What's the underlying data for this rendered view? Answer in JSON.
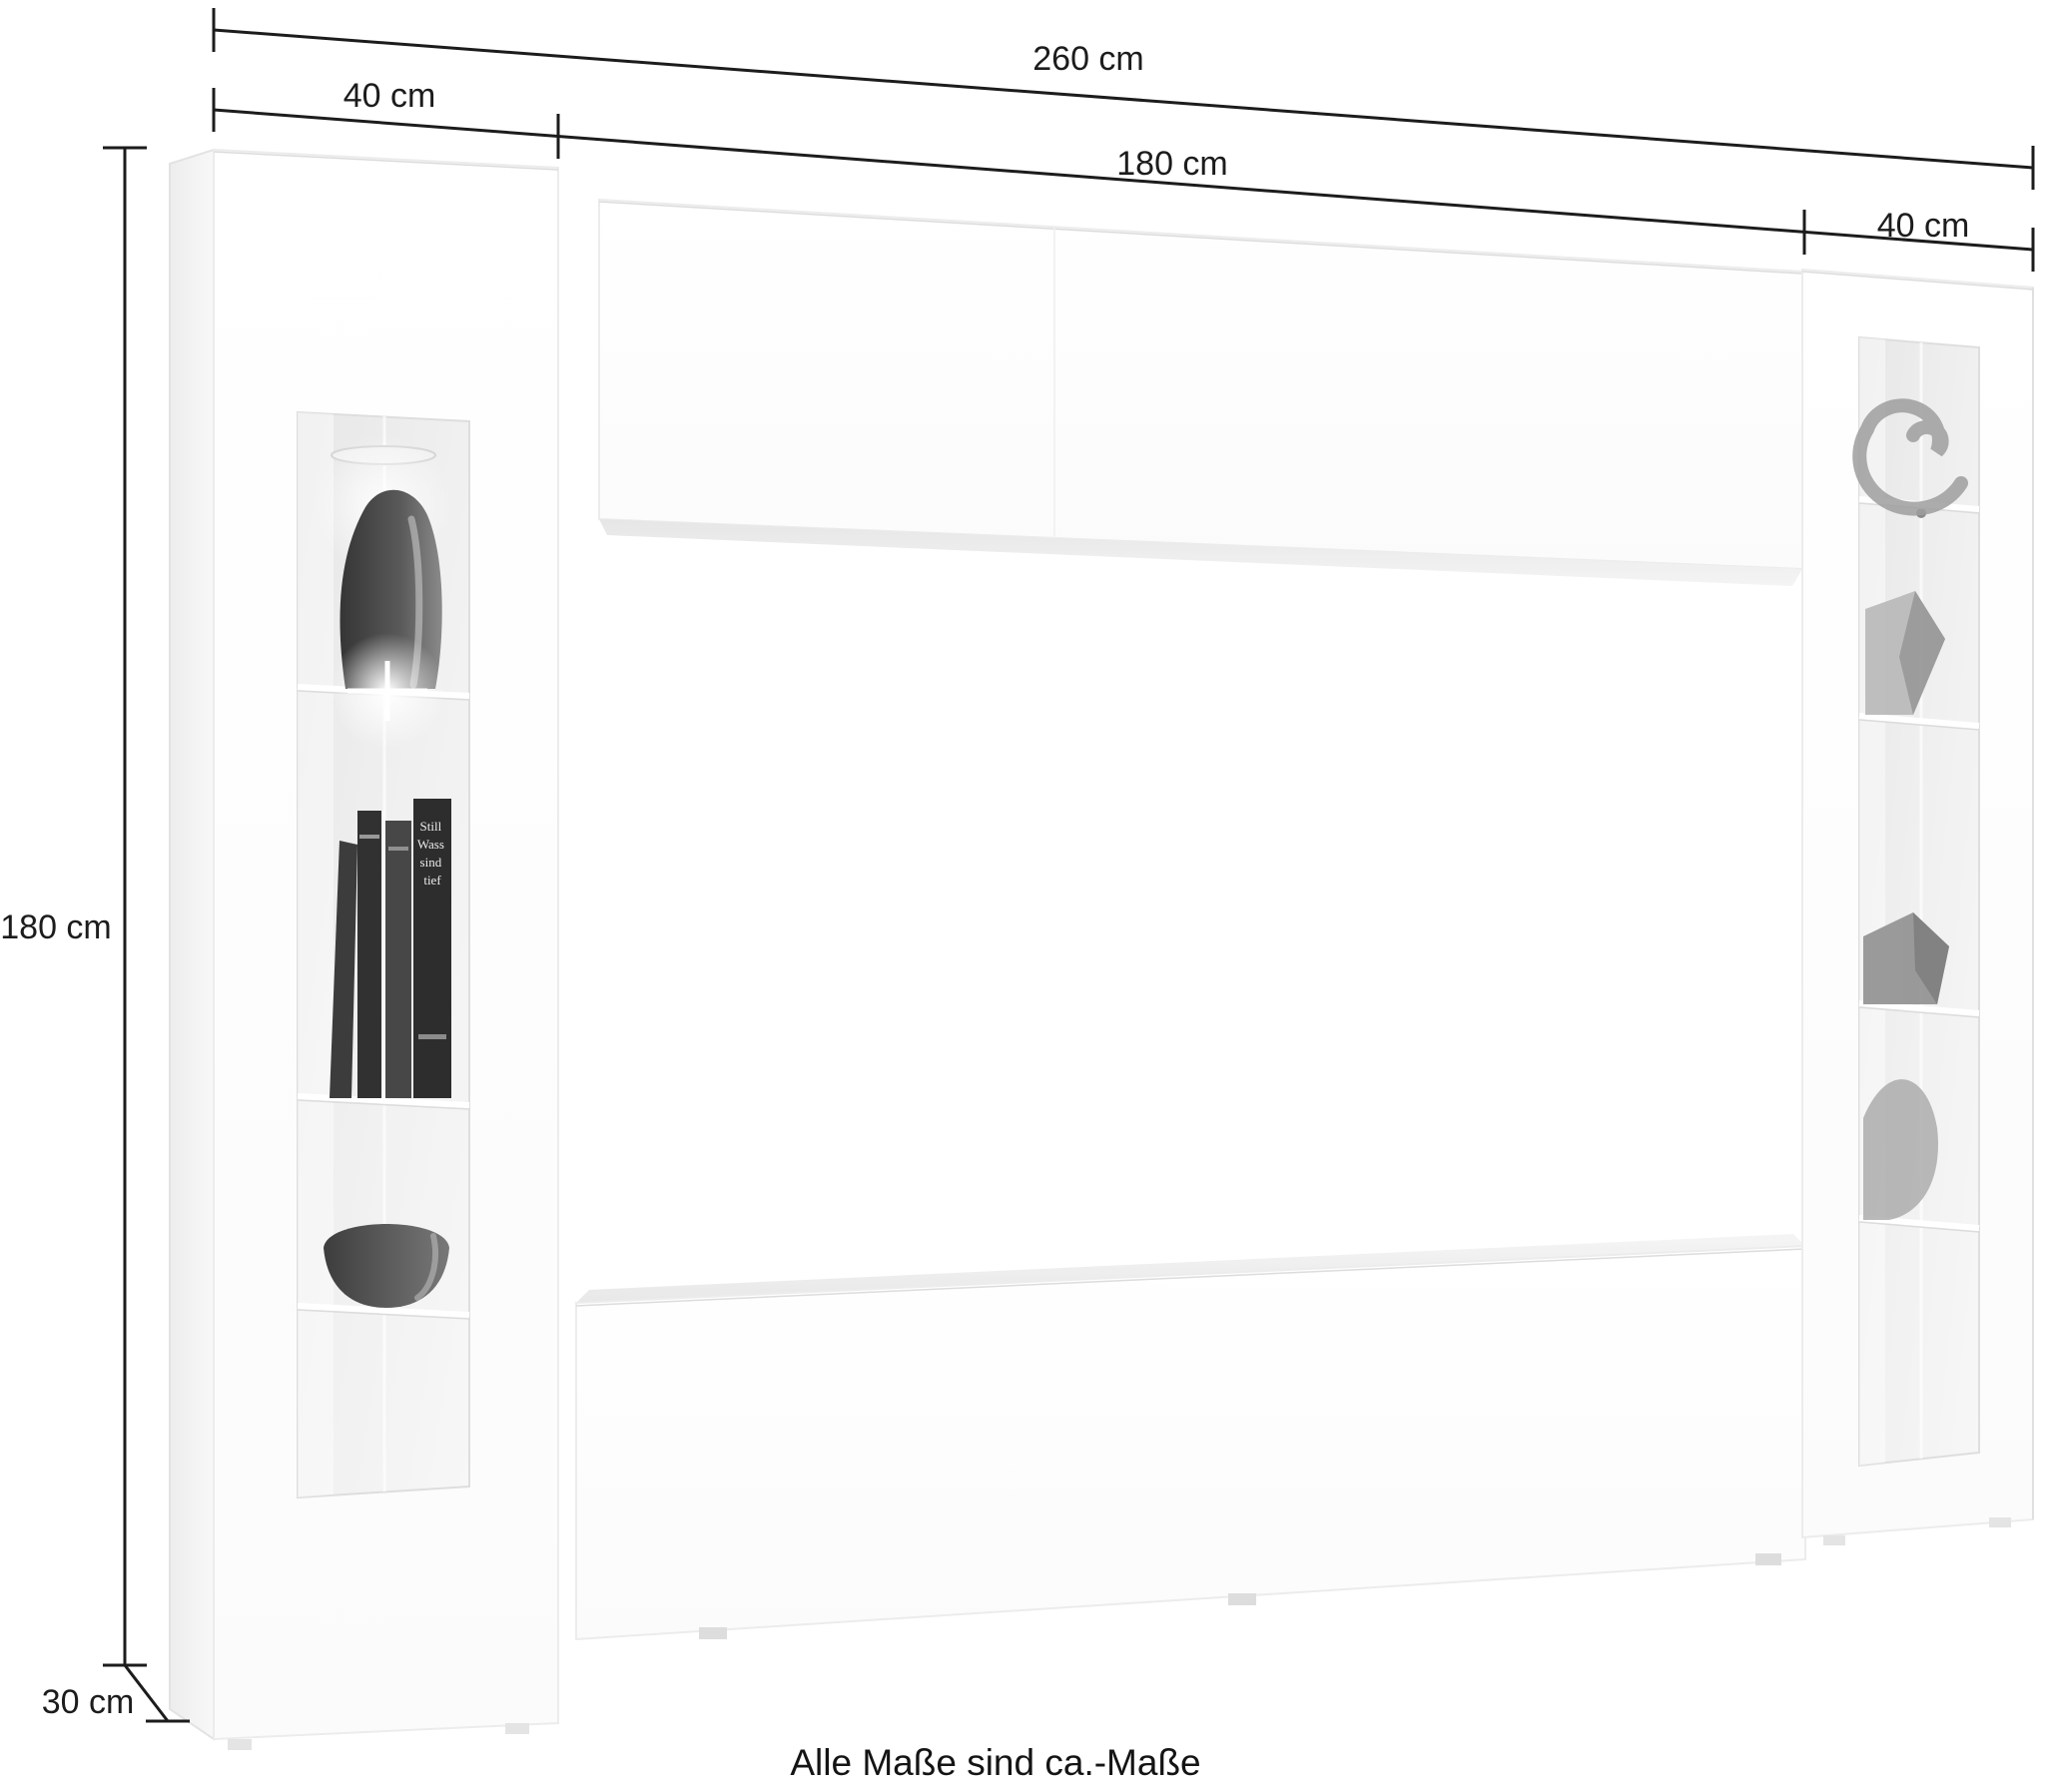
{
  "dimension_labels": {
    "total_width": "260 cm",
    "left_cabinet_width": "40 cm",
    "middle_width": "180 cm",
    "right_cabinet_width": "40 cm",
    "height": "180 cm",
    "depth": "30 cm"
  },
  "footnote": "Alle Maße sind ca.-Maße",
  "furniture": {
    "pieces": [
      "left-display-cabinet",
      "hanging-top-cabinet",
      "tv-bench",
      "right-display-cabinet"
    ],
    "book_spine_lines": [
      "Still",
      "Wass",
      "sind",
      "tief"
    ]
  },
  "colors": {
    "background": "#ffffff",
    "dimension_line": "#1c1c1c",
    "glass": "#ececec",
    "decor_dark": "#3f3f3f",
    "decor_mid": "#9a9a9a",
    "furniture_edge": "#e0e0e0"
  }
}
